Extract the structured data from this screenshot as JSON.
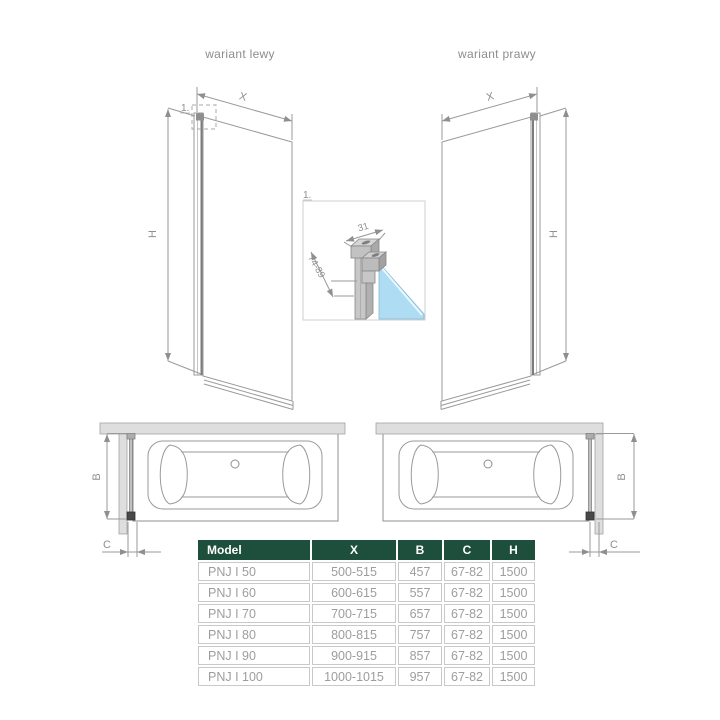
{
  "titles": {
    "left": "wariant lewy",
    "right": "wariant prawy"
  },
  "dims": {
    "x": "X",
    "h": "H",
    "b": "B",
    "c": "C",
    "detail_ref": "1.",
    "detail_width": "31",
    "detail_depth": "74-89"
  },
  "colors": {
    "table_header_green": "#1d4f3c",
    "line_gray": "#9a9a9a",
    "text_gray": "#8f8f8f",
    "glass_blue": "#aedcf3"
  },
  "table": {
    "headers": [
      "Model",
      "X",
      "B",
      "C",
      "H"
    ],
    "rows": [
      {
        "model": "PNJ I 50",
        "x": "500-515",
        "b": "457",
        "c": "67-82",
        "h": "1500"
      },
      {
        "model": "PNJ I 60",
        "x": "600-615",
        "b": "557",
        "c": "67-82",
        "h": "1500"
      },
      {
        "model": "PNJ I 70",
        "x": "700-715",
        "b": "657",
        "c": "67-82",
        "h": "1500"
      },
      {
        "model": "PNJ I 80",
        "x": "800-815",
        "b": "757",
        "c": "67-82",
        "h": "1500"
      },
      {
        "model": "PNJ I 90",
        "x": "900-915",
        "b": "857",
        "c": "67-82",
        "h": "1500"
      },
      {
        "model": "PNJ I 100",
        "x": "1000-1015",
        "b": "957",
        "c": "67-82",
        "h": "1500"
      }
    ]
  }
}
